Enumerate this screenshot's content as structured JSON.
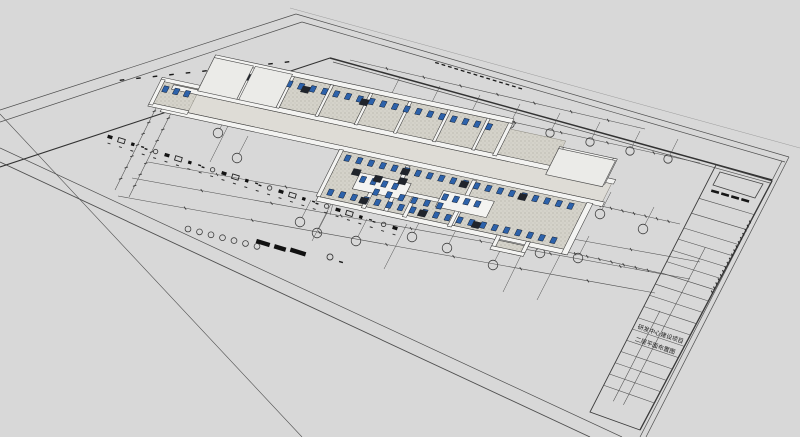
{
  "viewport": {
    "description": "3D perspective view of an architectural drawing sheet with extruded second-floor lab layout model",
    "background_color": "#d8d8d8"
  },
  "title_block": {
    "project_name": "研发中心建设项目",
    "drawing_title": "二层平面布置图"
  },
  "colors": {
    "paper_line": "#4f4f4f",
    "frame_heavy": "#323232",
    "wall_fill": "#f3f3f1",
    "wall_stroke": "#3a3a3a",
    "floor_fill": "#d5d3ca",
    "floor_dot": "#97948a",
    "corridor_fill": "#dedcd6",
    "roof_fill": "#ebebe8",
    "equipment_blue": "#2d62aa",
    "equipment_blue_dark": "#101c30",
    "machine_dark": "#20242b",
    "ink": "#1a1a1a"
  }
}
